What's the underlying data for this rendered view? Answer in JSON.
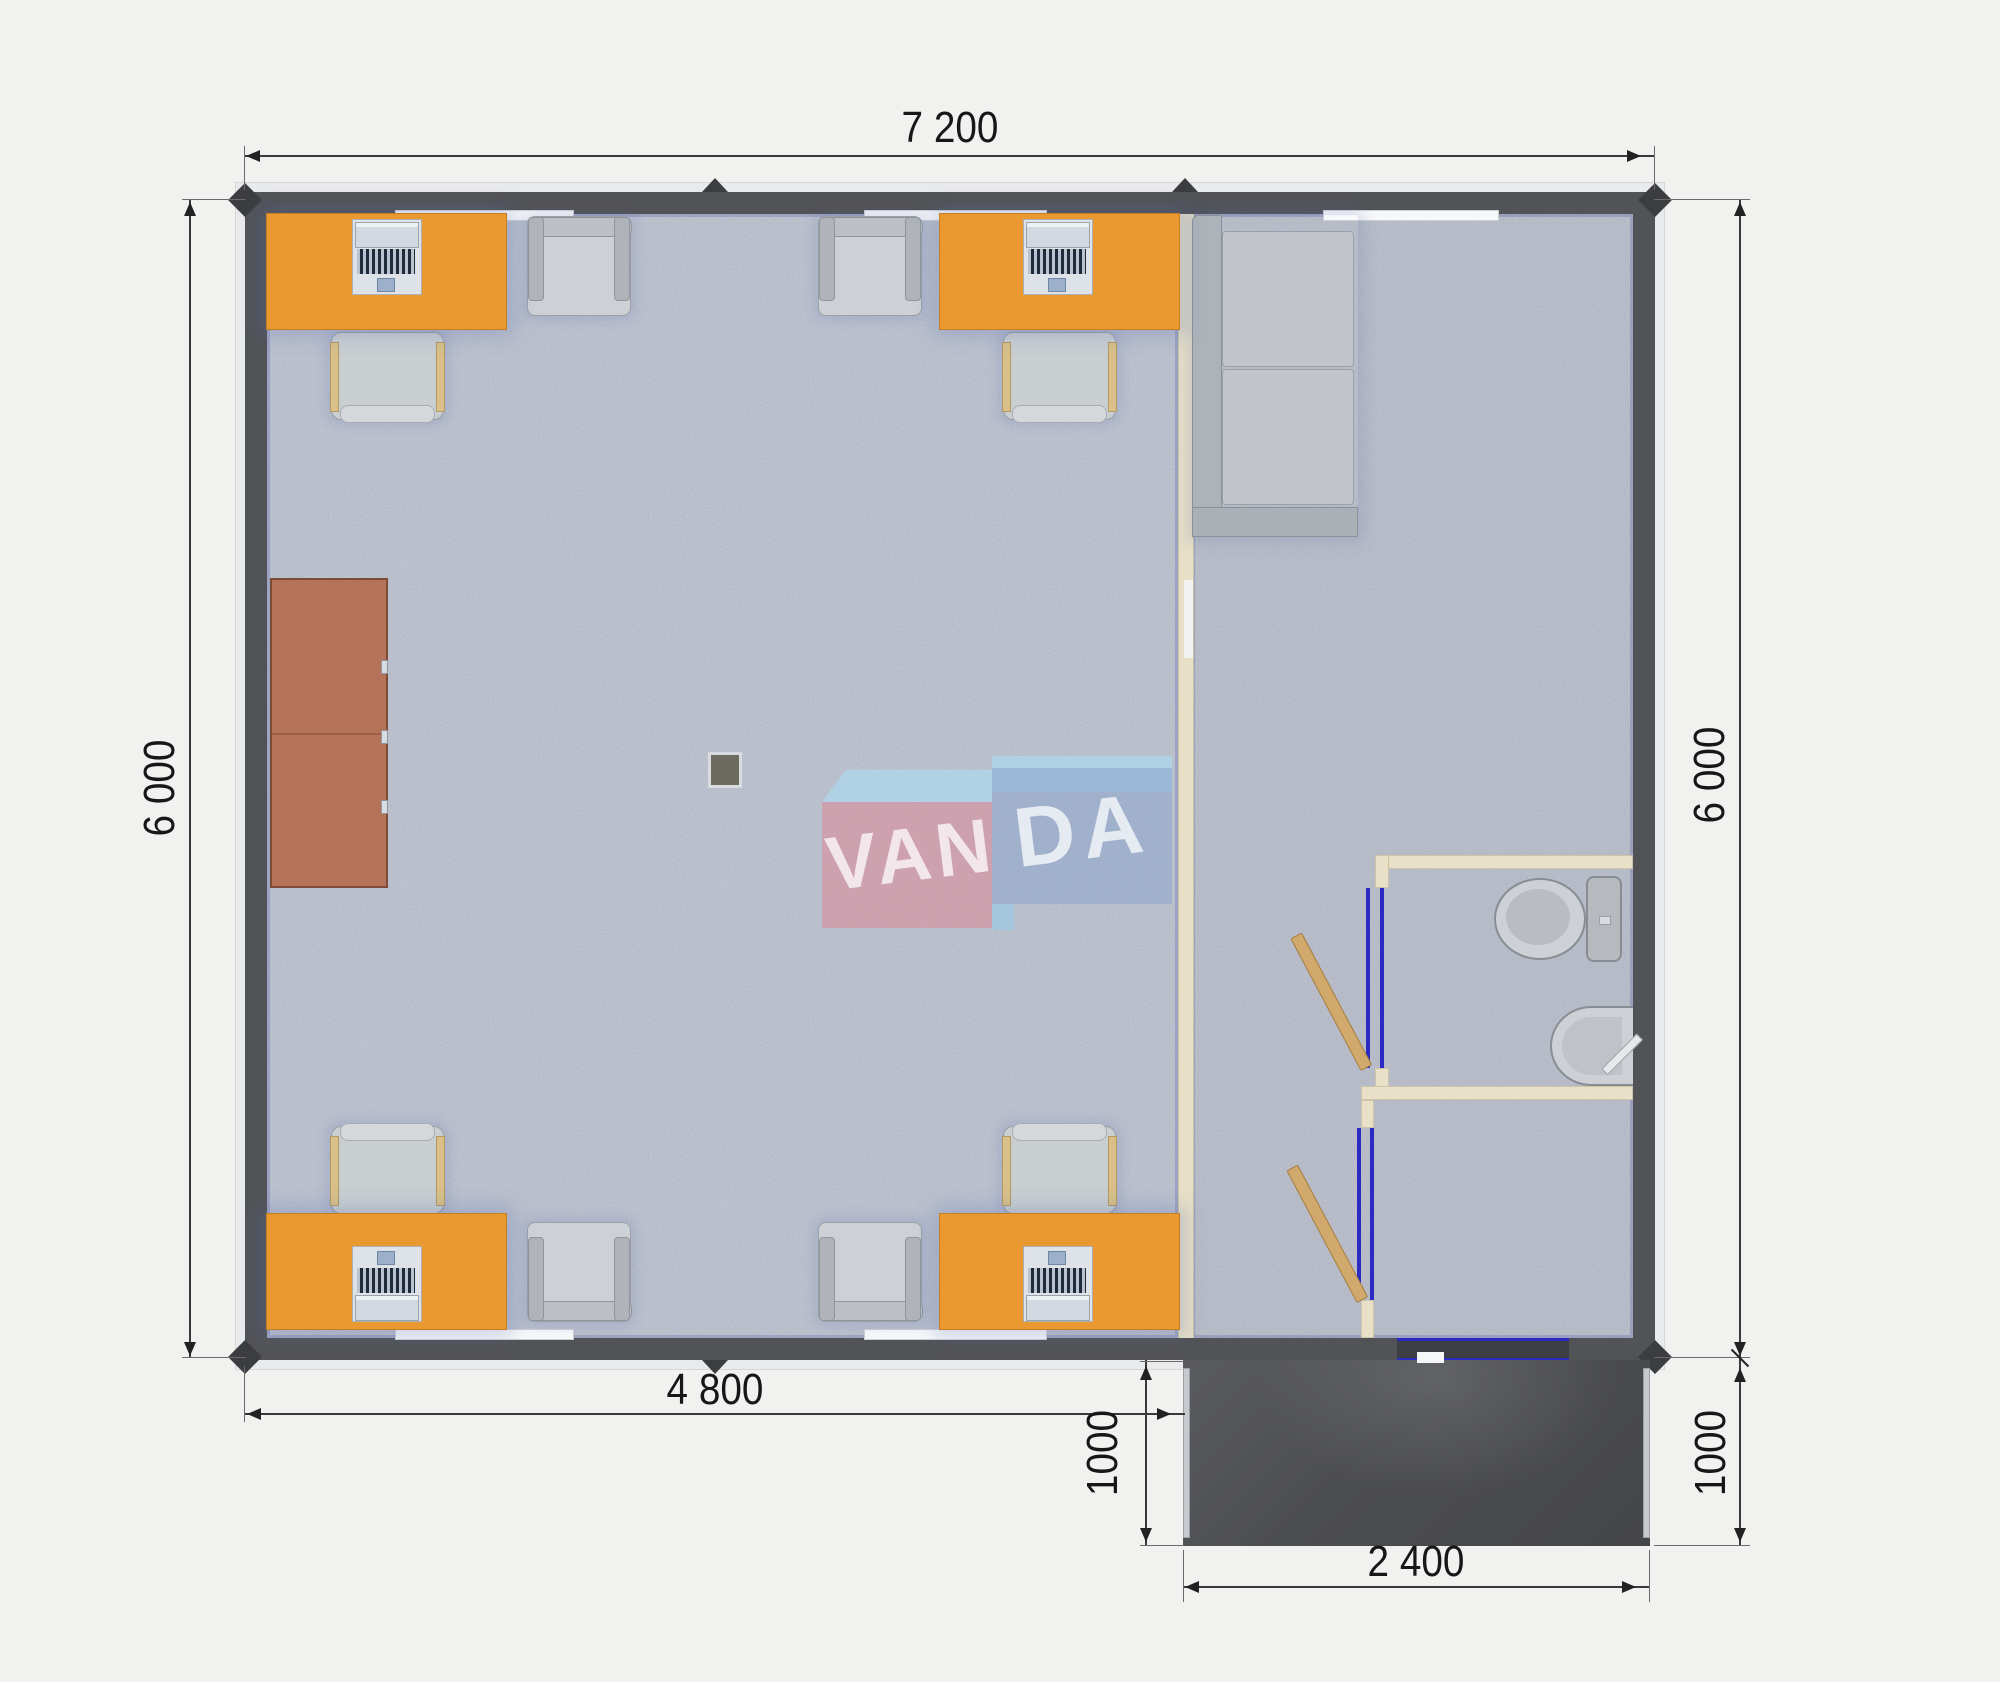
{
  "drawing": {
    "type": "modular-office-floor-plan",
    "rooms": [
      "office",
      "lounge",
      "bathroom",
      "entrance-hall",
      "porch"
    ],
    "furniture": [
      "desk-with-computer",
      "office-chair",
      "armchair",
      "cabinet",
      "sofa",
      "toilet",
      "sink",
      "stove"
    ]
  },
  "dimensions": {
    "top": "7 200",
    "left": "6 000",
    "right": "6 000",
    "bottom_office": "4 800",
    "porch_depth_left": "1000",
    "porch_depth_right": "1000",
    "porch_width": "2 400"
  },
  "watermark": {
    "left": "VAN",
    "right": "DA"
  },
  "colors": {
    "background": "#f1f1f0",
    "wall": "#525356",
    "partition_cream": "#e8e1c8",
    "floor": "#c6cbd6",
    "desk_orange": "#e9992f",
    "cabinet_sienna": "#b5735a",
    "furniture_gray": "#c9ced1",
    "door_leaf_tan": "#d2a96c",
    "door_frame_blue": "#2b2bc4",
    "porch_dark": "#4d4d50",
    "dimension_text": "#17171a",
    "watermark_pink": "#d98f9b",
    "watermark_blue": "#8fa7cc",
    "watermark_lightblue": "#aed6ea"
  }
}
